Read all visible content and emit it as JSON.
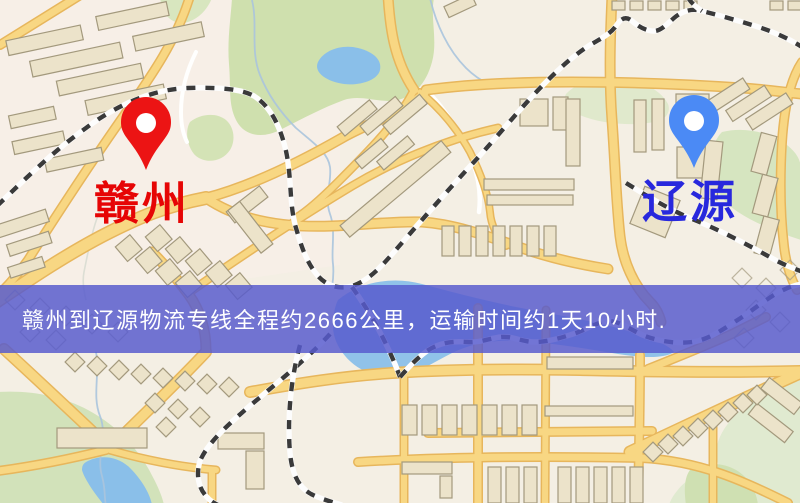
{
  "markers": {
    "origin": {
      "name": "赣州",
      "label_color": "#e60505",
      "pin_color": "#ec1414",
      "pin_icon": "location-pin-icon"
    },
    "destination": {
      "name": "辽源",
      "label_color": "#2828dd",
      "pin_color": "#4b8af5",
      "pin_icon": "location-pin-icon"
    }
  },
  "banner": {
    "text": "赣州到辽源物流专线全程约2666公里，运输时间约1天10小时.",
    "from_city": "赣州",
    "to_city": "辽源",
    "distance_km": "2666",
    "duration": "1天10小时",
    "background_color": "#575bcd",
    "text_color": "#ffffff"
  },
  "map_palette": {
    "background": "#f4efe4",
    "road_fill": "#f8d783",
    "road_casing": "#e7b65c",
    "building_fill": "#ece3ca",
    "building_stroke": "#a3997d",
    "green_area": "#cfe0ae",
    "green_pale": "#e0ead0",
    "water": "#8abfe9",
    "railway_dash": "#3a3a3a",
    "railway_base": "#fdfdfd"
  }
}
